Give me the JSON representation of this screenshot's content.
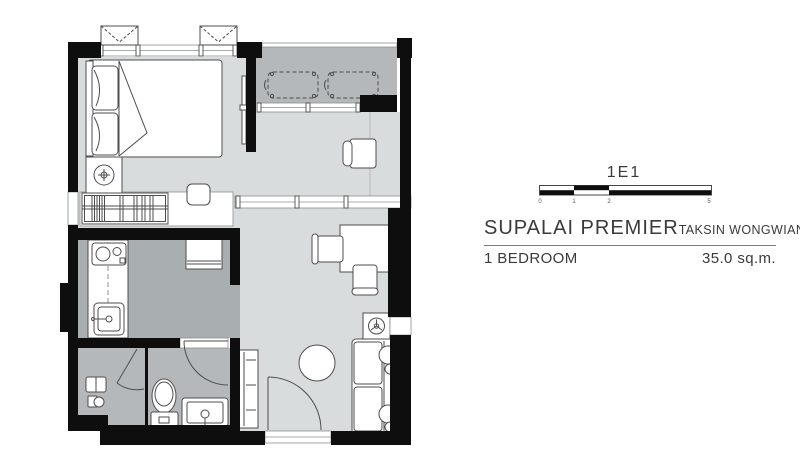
{
  "info": {
    "unit_code": "1E1",
    "project_name": "SUPALAI PREMIER",
    "project_location": "TAKSIN WONGWIANYAI",
    "unit_type": "1 BEDROOM",
    "unit_area": "35.0 sq.m.",
    "scale_ticks": [
      "0",
      "1",
      "2",
      "5"
    ]
  },
  "colors": {
    "wall": "#0e0e0e",
    "floor_light": "#d9dcdd",
    "floor_mid": "#b4b8ba",
    "floor_dark": "#a9aeb0",
    "outline": "#4d4d4d",
    "text": "#3a3a3a"
  }
}
